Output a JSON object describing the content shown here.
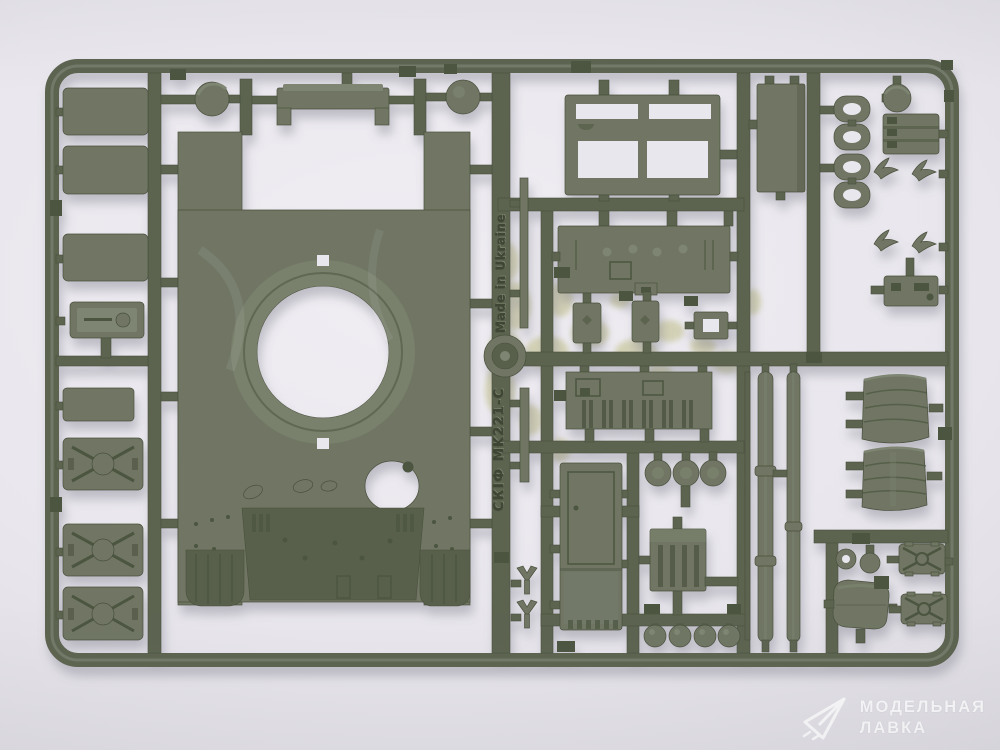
{
  "photo": {
    "alt": "Olive-green injection-molded plastic model kit sprue (tank upper hull and fittings) photographed on a light grey background"
  },
  "sprue_markings": {
    "made_in": "Made in Ukraine",
    "kit_code": "MK221-C",
    "brand": "СКІФ"
  },
  "watermark": {
    "line1": "МОДЕЛЬНАЯ",
    "line2": "ЛАВКА",
    "logo": "paper-plane-icon"
  },
  "colors": {
    "runner": "#5b6450",
    "part": "#6f7663",
    "light": "#7e8572",
    "dark": "#4c5440",
    "deck": "#59614b",
    "hole": "#e9e7ee",
    "residue": "#cfcdab",
    "edge": "#49503c",
    "background_hi": "#f0eef3",
    "background_lo": "#d3d1d7",
    "watermark": "#ffffff",
    "emboss": "#3a4130"
  }
}
